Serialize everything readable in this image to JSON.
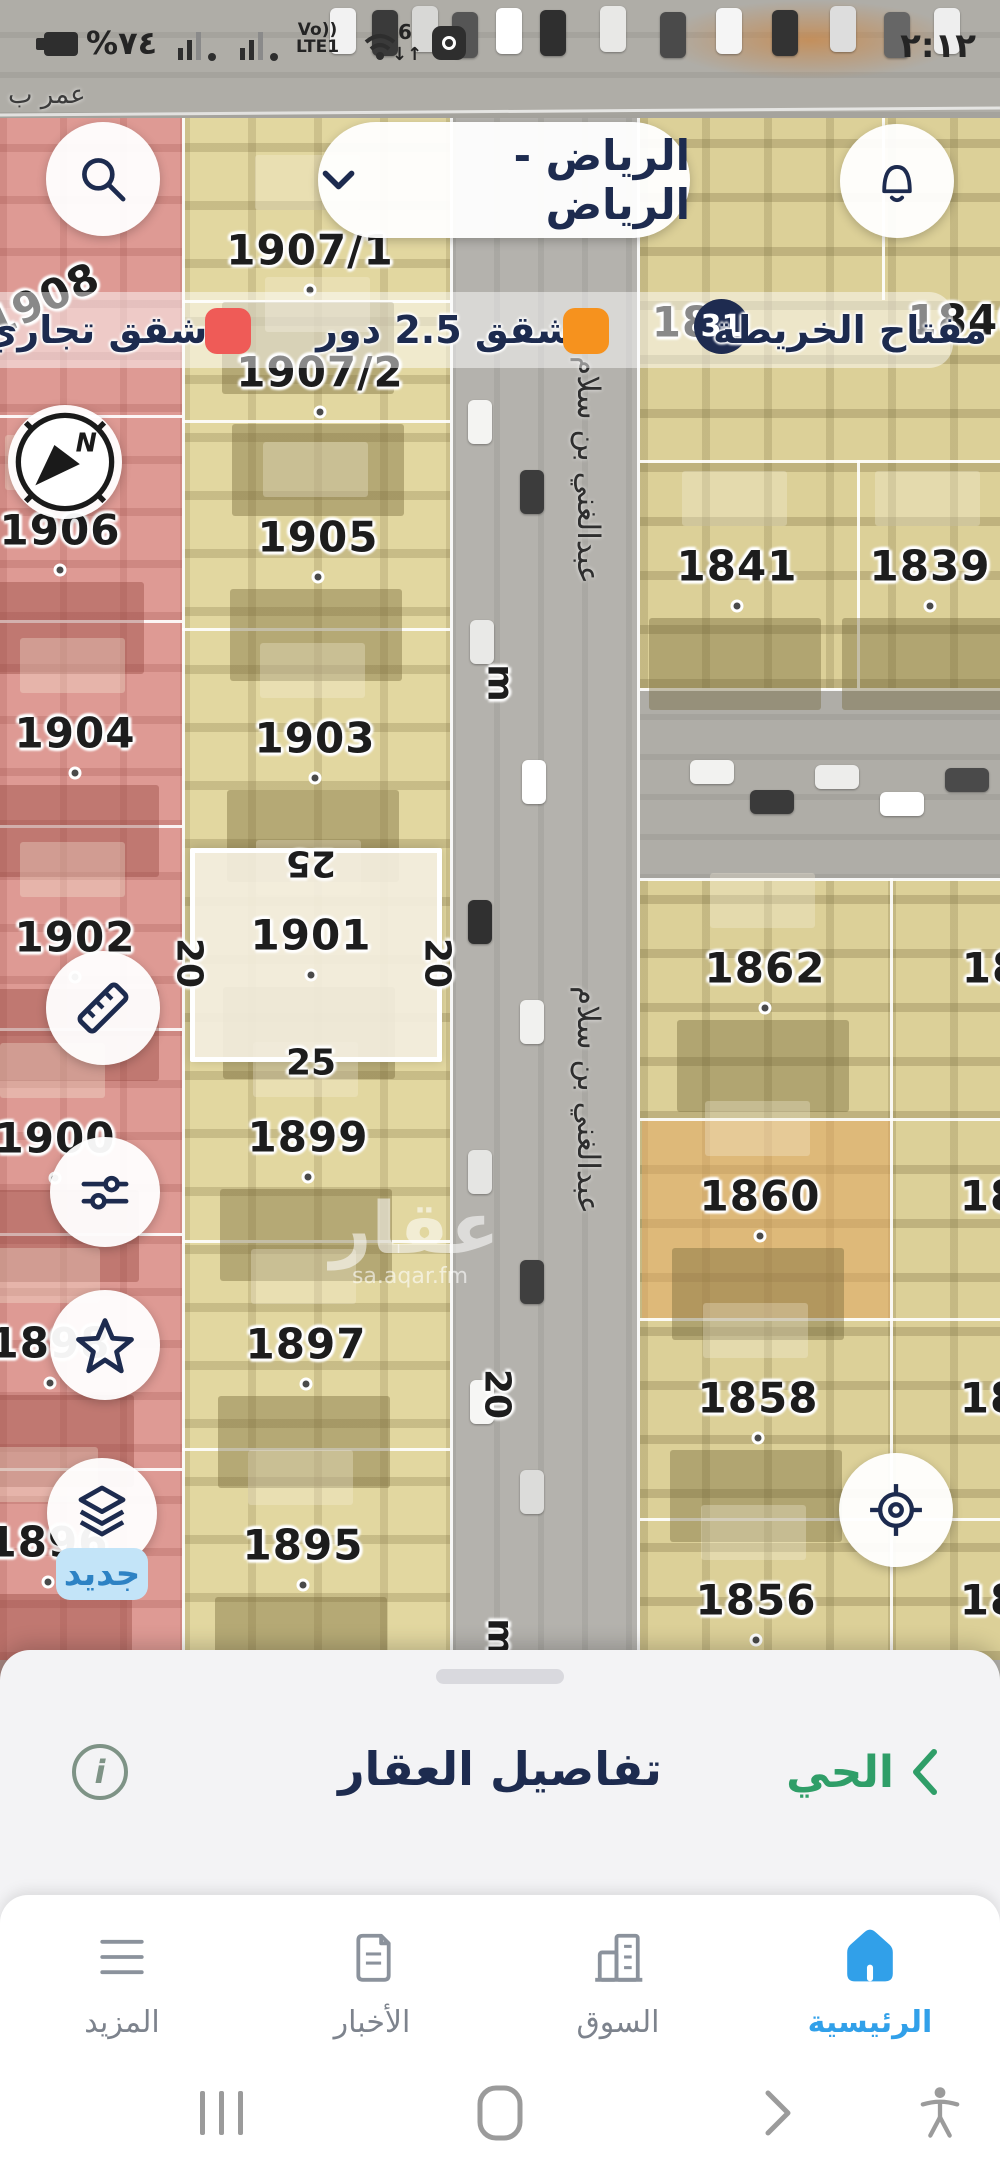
{
  "status_bar": {
    "time": "٢:١٢",
    "battery_percent": "%٧٤",
    "volte_top": "Vo))",
    "volte_bottom": "LTE1",
    "wifi_gen": "6",
    "wifi_arrows": "↓↑"
  },
  "top_bar": {
    "location": "الرياض - الرياض"
  },
  "legend": {
    "items": [
      {
        "label": "شقق تجاري",
        "color": "#ef5b57"
      },
      {
        "label": "شقق 2.5 دور",
        "color": "#f6921e"
      },
      {
        "label": "مفتاح الخريطة",
        "badge": "31"
      }
    ]
  },
  "map": {
    "street_top": "عمر ب",
    "street_vertical": "عبدالغني بن سلام",
    "street_vertical_positions": [
      {
        "x": 588,
        "y": 470
      },
      {
        "x": 588,
        "y": 1100
      }
    ],
    "road_markers": [
      {
        "text": "m",
        "x": 500,
        "y": 683
      },
      {
        "text": "20",
        "x": 497,
        "y": 1394
      },
      {
        "text": "m",
        "x": 500,
        "y": 1637
      }
    ],
    "plots": [
      {
        "id": "1908",
        "x": 42,
        "y": 300,
        "rot": -25
      },
      {
        "id": "1906",
        "x": 60,
        "y": 530,
        "dot": true
      },
      {
        "id": "1904",
        "x": 75,
        "y": 733,
        "dot": true
      },
      {
        "id": "1902",
        "x": 75,
        "y": 937,
        "dot": true
      },
      {
        "id": "1900",
        "x": 55,
        "y": 1138,
        "dot": true
      },
      {
        "id": "1898",
        "x": 50,
        "y": 1343,
        "dot": true
      },
      {
        "id": "1896",
        "x": 48,
        "y": 1542,
        "dot": true
      },
      {
        "id": "1907/1",
        "x": 310,
        "y": 250,
        "dot": true
      },
      {
        "id": "1907/2",
        "x": 320,
        "y": 372,
        "dot": true
      },
      {
        "id": "1905",
        "x": 318,
        "y": 537,
        "dot": true
      },
      {
        "id": "1903",
        "x": 315,
        "y": 738,
        "dot": true
      },
      {
        "id": "1901",
        "x": 311,
        "y": 935,
        "dot": true
      },
      {
        "id": "1899",
        "x": 308,
        "y": 1137,
        "dot": true
      },
      {
        "id": "1897",
        "x": 306,
        "y": 1344,
        "dot": true
      },
      {
        "id": "1895",
        "x": 303,
        "y": 1545,
        "dot": true
      },
      {
        "id": "1841",
        "x": 737,
        "y": 566,
        "dot": true
      },
      {
        "id": "1839",
        "x": 930,
        "y": 566,
        "dot": true
      },
      {
        "id": "1862",
        "x": 765,
        "y": 968,
        "dot": true
      },
      {
        "id": "1860",
        "x": 760,
        "y": 1196,
        "dot": true
      },
      {
        "id": "1858",
        "x": 758,
        "y": 1398,
        "dot": true
      },
      {
        "id": "1856",
        "x": 756,
        "y": 1600,
        "dot": true
      },
      {
        "id": "18",
        "x": 992,
        "y": 968
      },
      {
        "id": "18",
        "x": 990,
        "y": 1196
      },
      {
        "id": "18",
        "x": 990,
        "y": 1398
      },
      {
        "id": "18",
        "x": 990,
        "y": 1600
      },
      {
        "id": "18",
        "x": 682,
        "y": 322
      },
      {
        "id": "1840",
        "x": 968,
        "y": 320
      }
    ],
    "selected_plot": {
      "id": "1901",
      "dim_top": "25",
      "dim_bottom": "25",
      "dim_left": "20",
      "dim_right": "20"
    },
    "watermark": {
      "name": "عقار",
      "url": "sa.aqar.fm"
    }
  },
  "map_buttons": {
    "new_badge": "جديد",
    "compass_n": "N"
  },
  "bottom_sheet": {
    "back_label": "الحي",
    "title": "تفاصيل العقار",
    "info": "i"
  },
  "bottom_nav": {
    "items": [
      {
        "label": "الرئيسية",
        "icon": "home",
        "active": true
      },
      {
        "label": "السوق",
        "icon": "market",
        "active": false
      },
      {
        "label": "الأخبار",
        "icon": "news",
        "active": false
      },
      {
        "label": "المزيد",
        "icon": "more",
        "active": false
      }
    ]
  },
  "colors": {
    "accent_navy": "#1d2b4f",
    "active_blue": "#31a0e9",
    "green": "#2f9e68",
    "badge_navy": "#1e2b50",
    "legend_red": "#ef5b57",
    "legend_orange": "#f6921e"
  }
}
